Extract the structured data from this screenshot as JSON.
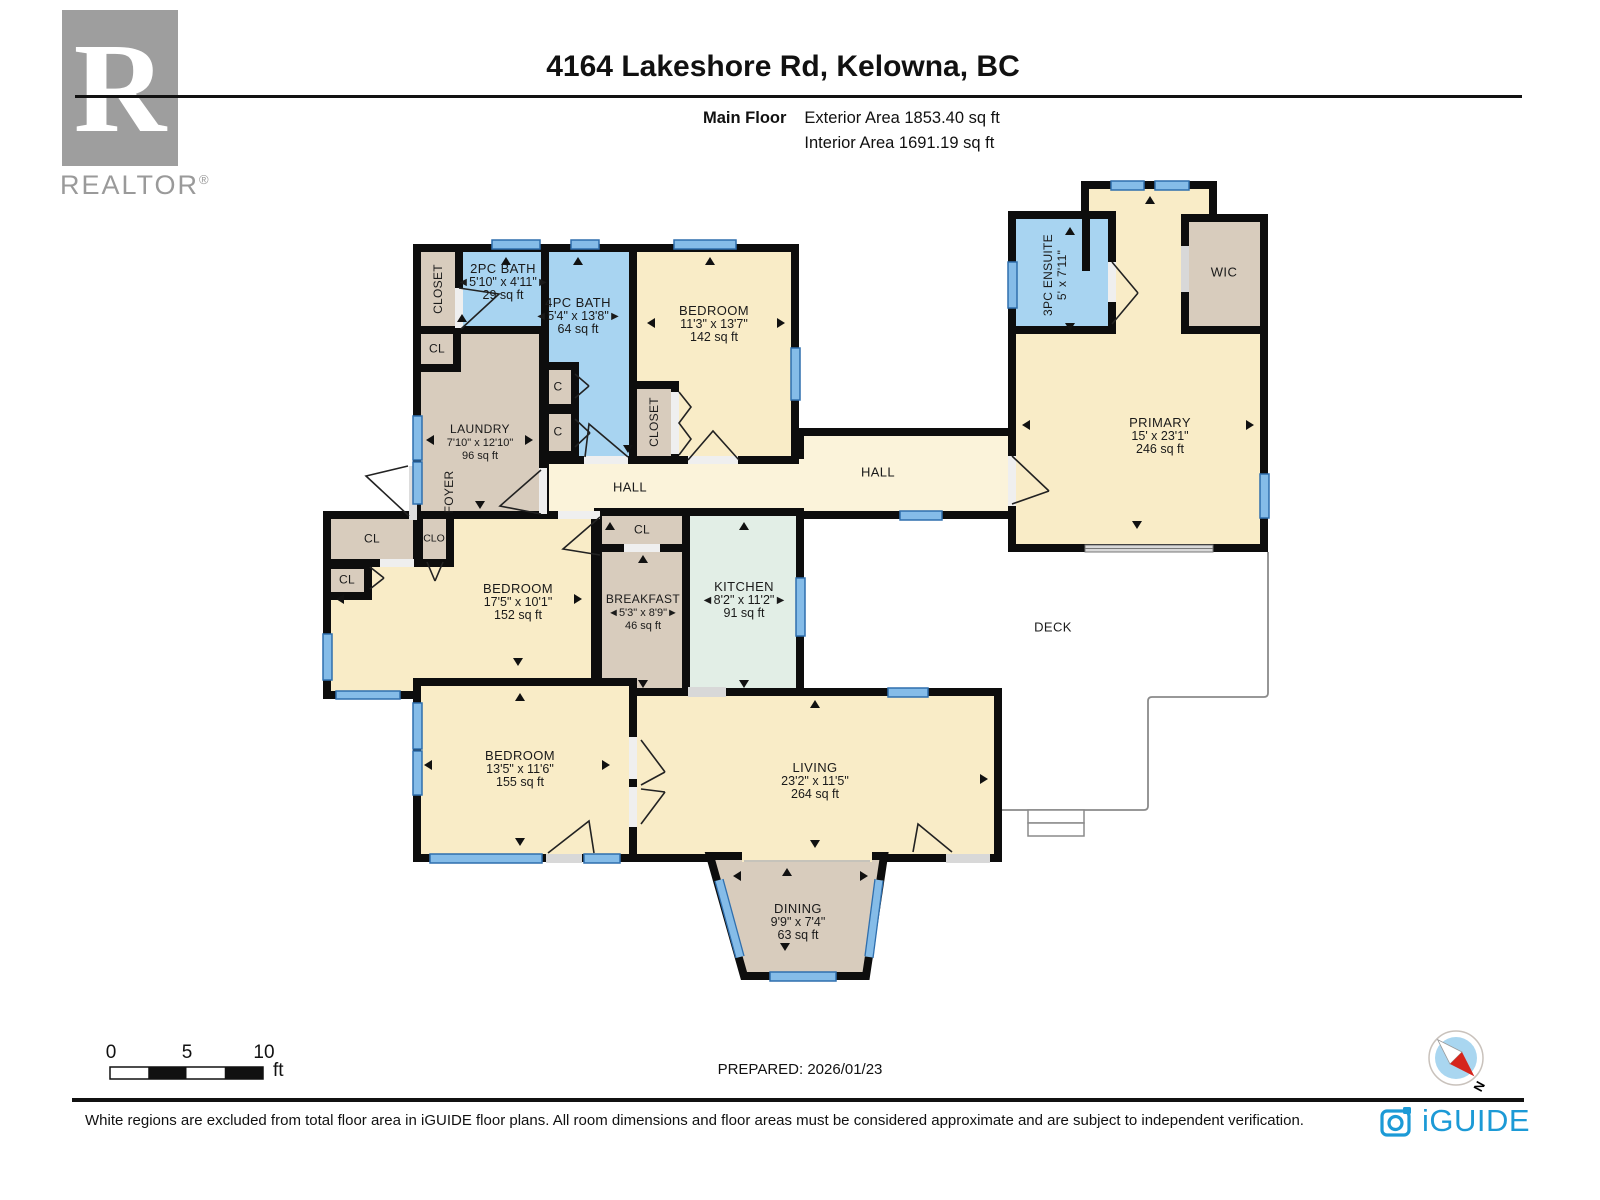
{
  "header": {
    "title": "4164 Lakeshore Rd, Kelowna, BC",
    "floor_label": "Main Floor",
    "exterior_area": "Exterior Area 1853.40 sq ft",
    "interior_area": "Interior Area 1691.19 sq ft"
  },
  "branding": {
    "realtor_r": "R",
    "realtor_wordmark": "REALTOR",
    "realtor_reg": "®",
    "iguide_wordmark": "iGUIDE"
  },
  "compass": {
    "north": "N"
  },
  "scale_bar": {
    "tick0": "0",
    "tick5": "5",
    "tick10": "10",
    "unit": "ft"
  },
  "rooms": {
    "closet_a": {
      "name": "CLOSET"
    },
    "bath_2pc": {
      "name": "2PC BATH",
      "dims": "◄5'10\" x 4'11\"►",
      "area": "29 sq ft"
    },
    "cl_a": {
      "name": "CL"
    },
    "laundry": {
      "name": "LAUNDRY",
      "dims": "7'10\" x 12'10\"",
      "area": "96 sq ft"
    },
    "foyer": {
      "name": "FOYER"
    },
    "bath_4pc": {
      "name": "4PC BATH",
      "dims": "◄5'4\" x 13'8\"►",
      "area": "64 sq ft"
    },
    "c1": {
      "name": "C"
    },
    "c2": {
      "name": "C"
    },
    "bedroom_top": {
      "name": "BEDROOM",
      "dims": "11'3\" x 13'7\"",
      "area": "142 sq ft"
    },
    "closet_b": {
      "name": "CLOSET"
    },
    "hall_a": {
      "name": "HALL"
    },
    "hall_b": {
      "name": "HALL"
    },
    "ensuite": {
      "name": "3PC ENSUITE",
      "dims": "5' x 7'11\""
    },
    "wic": {
      "name": "WIC"
    },
    "primary": {
      "name": "PRIMARY",
      "dims": "15' x 23'1\"",
      "area": "246 sq ft"
    },
    "cl_m1": {
      "name": "CL"
    },
    "clo": {
      "name": "CLO"
    },
    "cl_m2": {
      "name": "CL"
    },
    "bedroom_mid": {
      "name": "BEDROOM",
      "dims": "17'5\" x 10'1\"",
      "area": "152 sq ft"
    },
    "cl_k": {
      "name": "CL"
    },
    "breakfast": {
      "name": "BREAKFAST",
      "dims": "◄5'3\" x 8'9\"►",
      "area": "46 sq ft"
    },
    "kitchen": {
      "name": "KITCHEN",
      "dims": "◄8'2\" x 11'2\"►",
      "area": "91 sq ft"
    },
    "bedroom_low": {
      "name": "BEDROOM",
      "dims": "13'5\" x 11'6\"",
      "area": "155 sq ft"
    },
    "living": {
      "name": "LIVING",
      "dims": "23'2\" x 11'5\"",
      "area": "264 sq ft"
    },
    "dining": {
      "name": "DINING",
      "dims": "9'9\" x 7'4\"",
      "area": "63 sq ft"
    },
    "deck": {
      "name": "DECK"
    }
  },
  "footer": {
    "prepared": "PREPARED: 2026/01/23",
    "disclaimer": "White regions are excluded from total floor area in iGUIDE floor plans. All room dimensions and floor areas must be considered approximate and are subject to independent verification."
  }
}
